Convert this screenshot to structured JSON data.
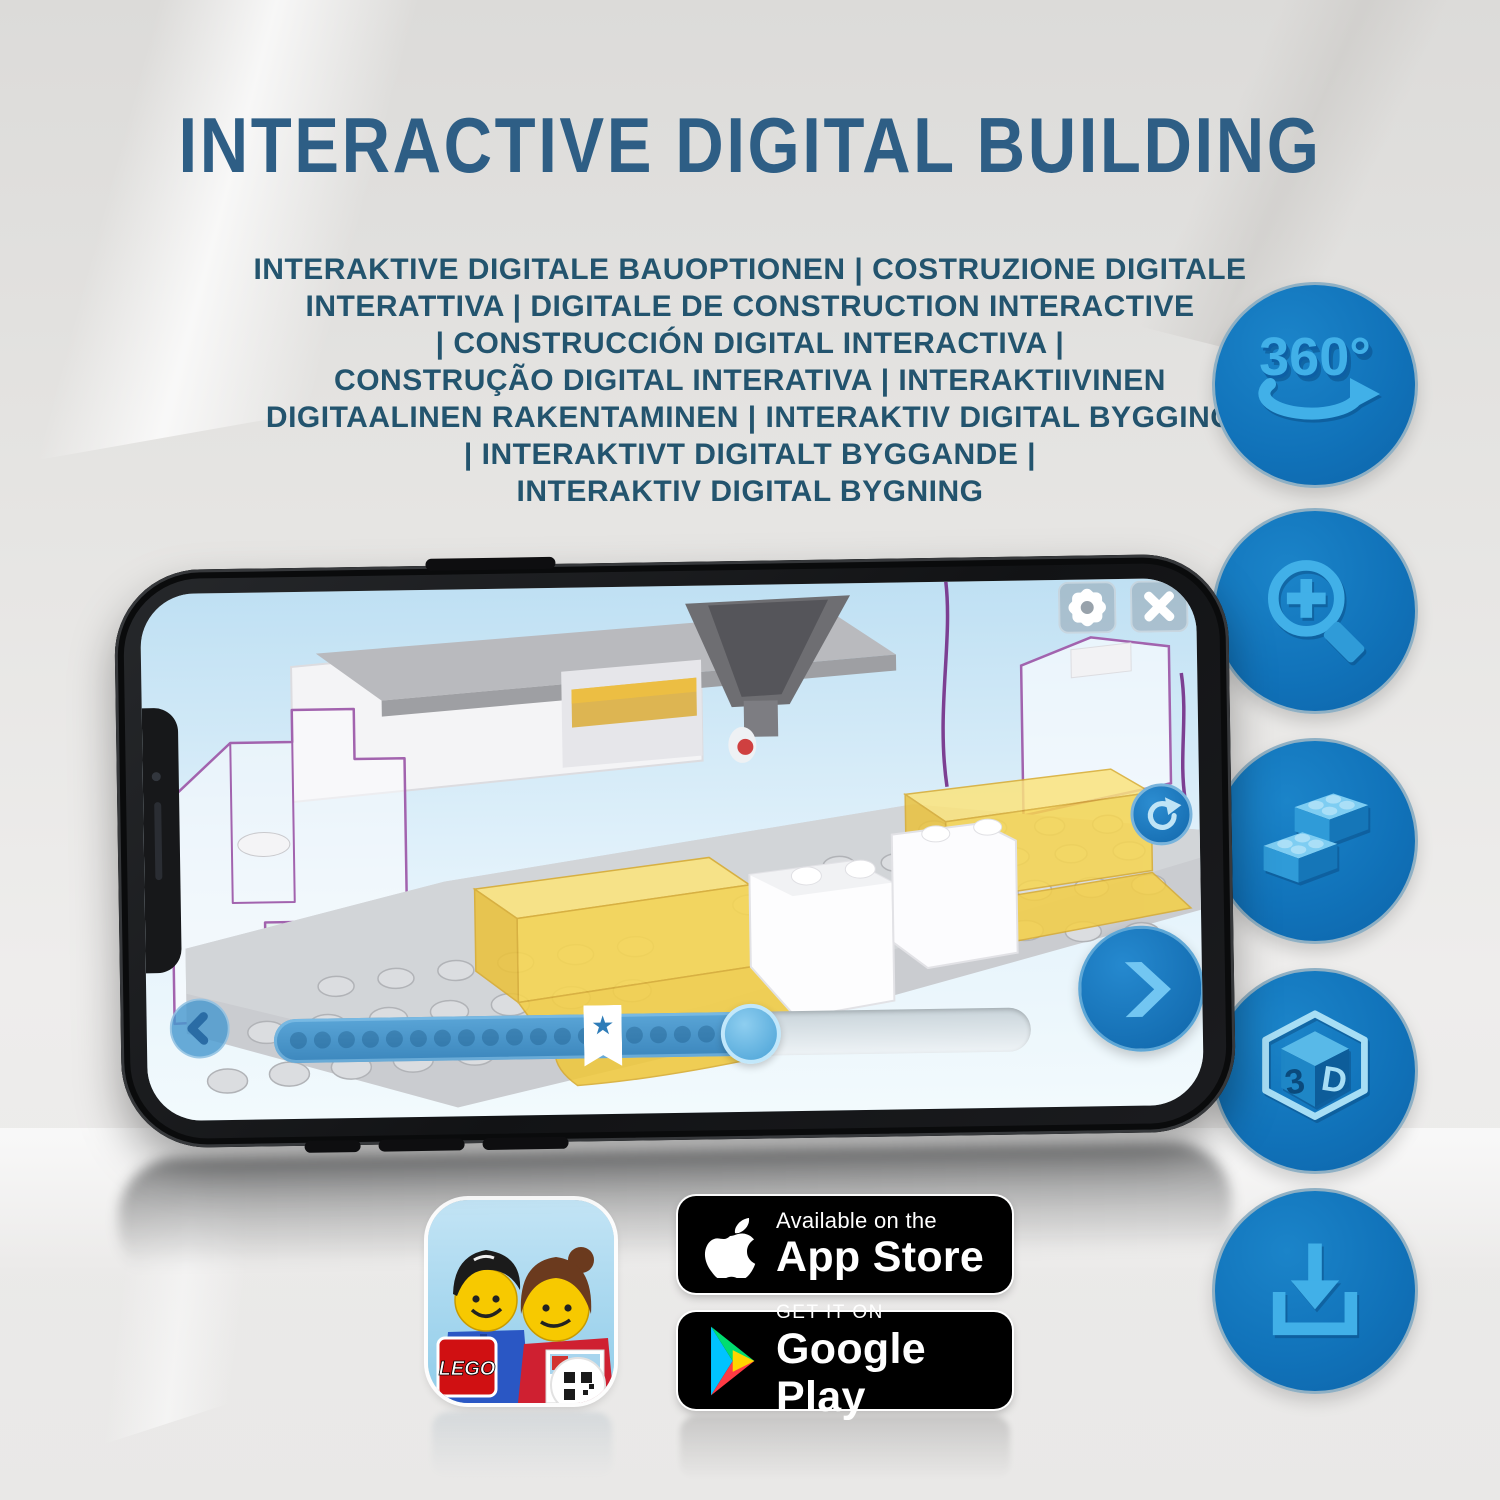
{
  "header": {
    "title": "INTERACTIVE DIGITAL BUILDING",
    "subtitle_lines": [
      "INTERAKTIVE DIGITALE BAUOPTIONEN | COSTRUZIONE DIGITALE",
      "INTERATTIVA | DIGITALE DE CONSTRUCTION INTERACTIVE",
      "| CONSTRUCCIÓN DIGITAL INTERACTIVA |",
      "CONSTRUÇÃO DIGITAL INTERATIVA | INTERAKTIIVINEN",
      "DIGITAALINEN RAKENTAMINEN | INTERAKTIV DIGITAL BYGGING",
      "| INTERAKTIVT DIGITALT BYGGANDE |",
      "INTERAKTIV DIGITAL BYGNING"
    ]
  },
  "features": {
    "rotate_360_label": "360°",
    "cube_left_label": "3",
    "cube_right_label": "D",
    "icon_names": [
      "360-rotation-icon",
      "zoom-in-icon",
      "lego-brick-icon",
      "3d-cube-icon",
      "download-icon"
    ]
  },
  "phone": {
    "slider": {
      "dot_count": 18,
      "star_glyph": "★"
    }
  },
  "badges": {
    "app_store": {
      "tagline": "Available on the",
      "store": "App Store"
    },
    "google_play": {
      "tagline": "GET IT ON",
      "store": "Google Play"
    },
    "lego_app": {
      "logo": "LEGO"
    }
  },
  "colors": {
    "accent_blue": "#1173BA",
    "glyph_blue": "#41B0E8",
    "title_blue": "#2E5E85",
    "lego_yellow": "#F7D650",
    "ghost_outline_purple": "#A263AE"
  }
}
